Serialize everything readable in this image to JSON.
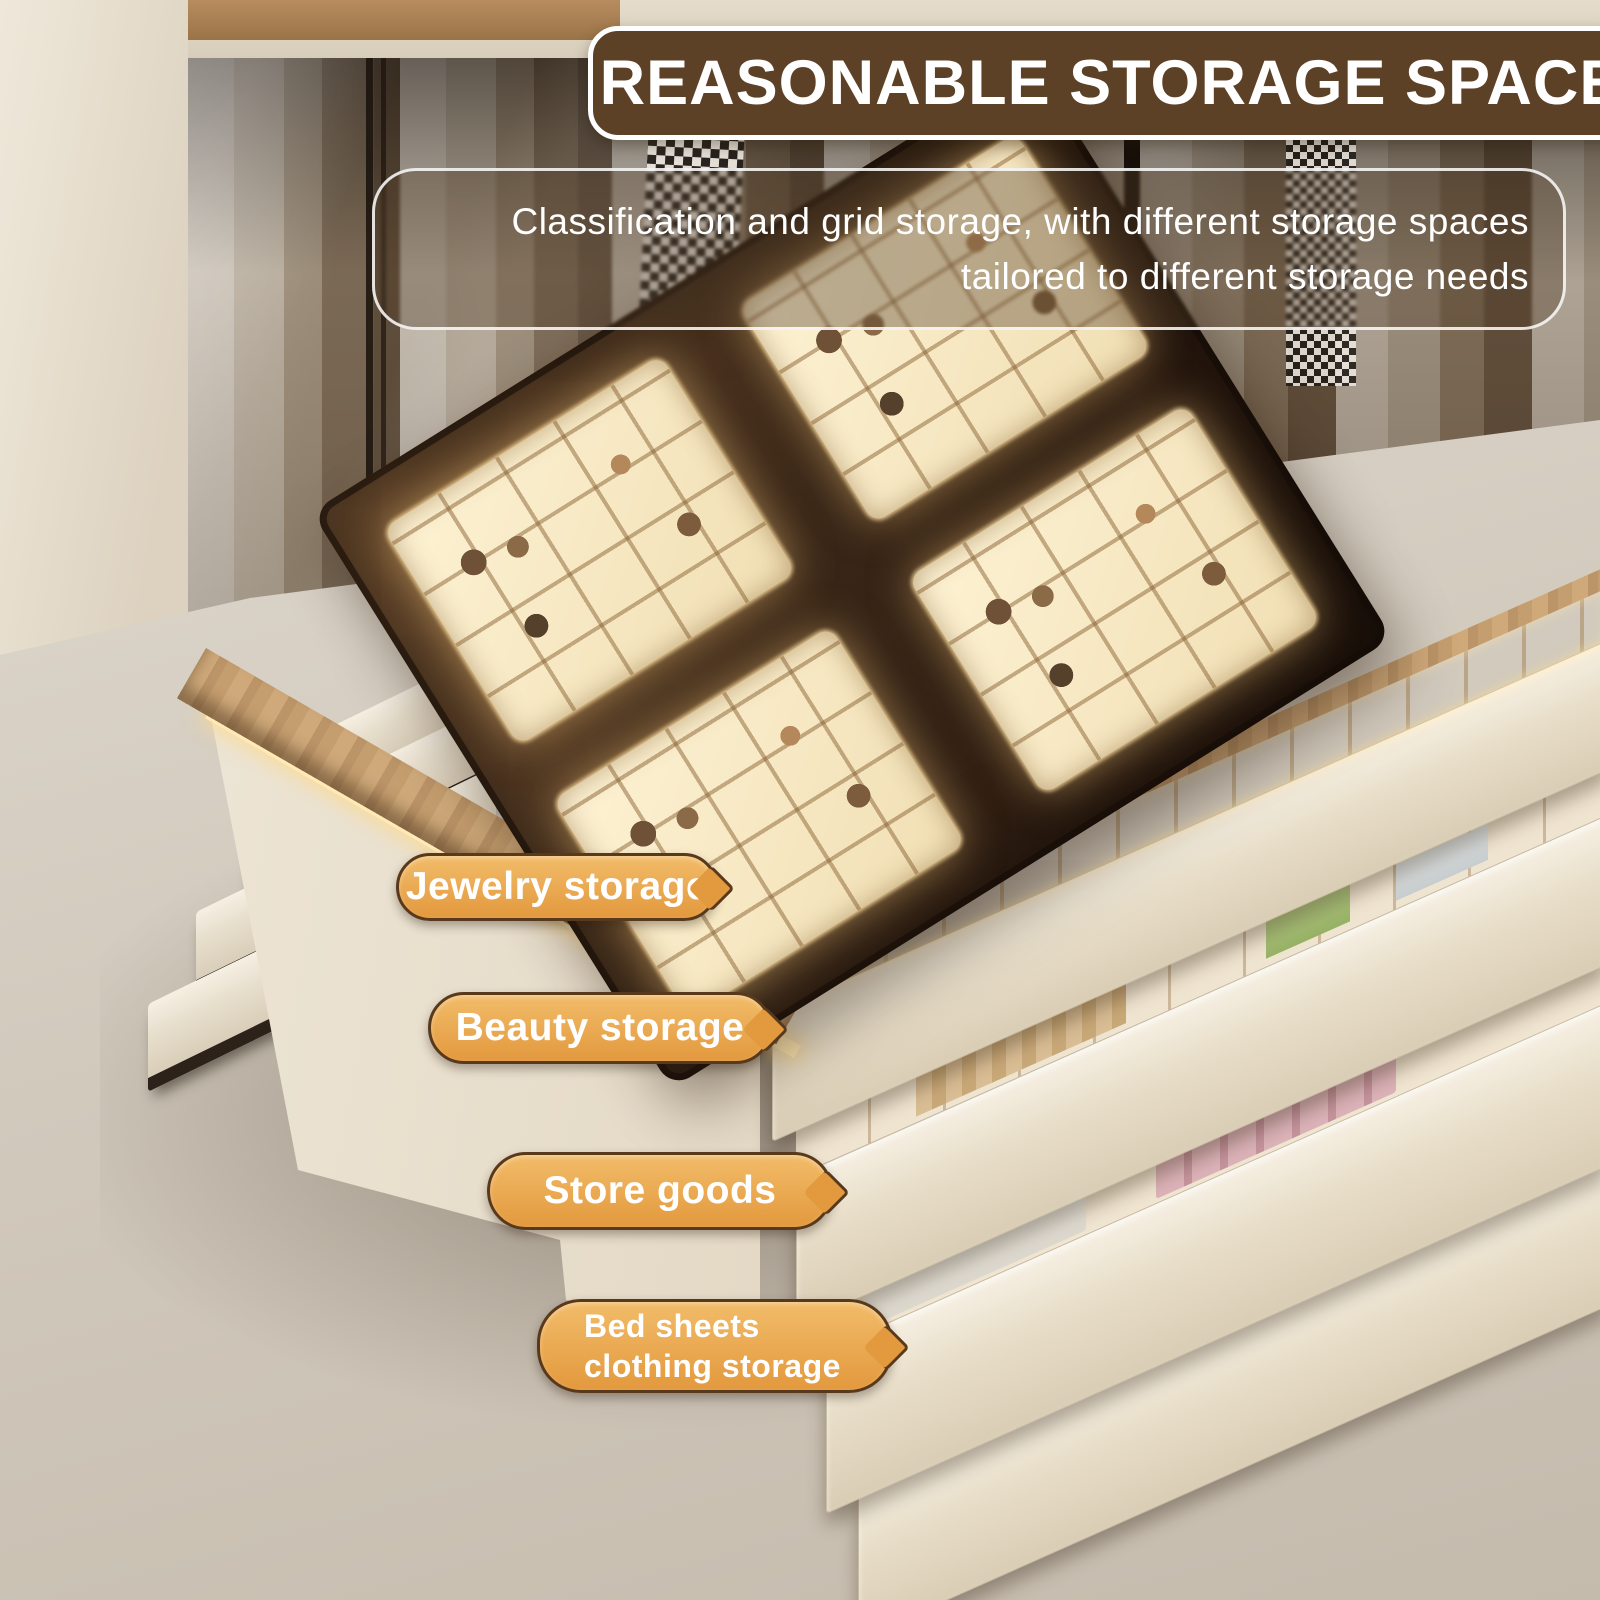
{
  "header": {
    "banner": {
      "label": "REASONABLE STORAGE SPACE"
    },
    "description": {
      "line1": "Classification and grid storage, with different storage spaces",
      "line2": "tailored to different storage needs"
    }
  },
  "callouts": [
    {
      "id": "jewelry-storage",
      "lines": [
        "Jewelry storage"
      ]
    },
    {
      "id": "beauty-storage",
      "lines": [
        "Beauty storage"
      ]
    },
    {
      "id": "store-goods",
      "lines": [
        "Store goods"
      ]
    },
    {
      "id": "bed-sheets-clothing-storage",
      "lines": [
        "Bed sheets",
        "clothing storage"
      ]
    }
  ],
  "colors": {
    "banner-bg": "#5d4126",
    "banner-text": "#ffffff",
    "pill-bg-top": "#f2bc69",
    "pill-bg-bottom": "#e3993e",
    "pill-border": "#59391c",
    "pill-text": "#ffffff",
    "desc-text": "#ffffff",
    "glass-top": "#3a2718",
    "tray": "#f6e8c6",
    "floor": "#d5cdc1"
  }
}
